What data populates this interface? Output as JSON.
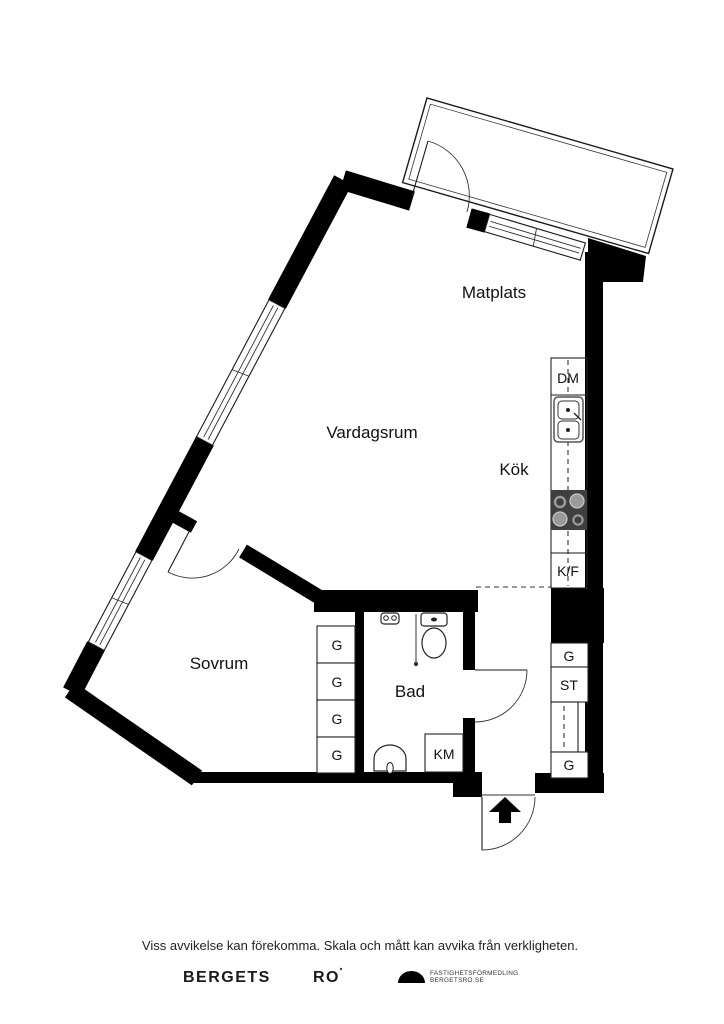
{
  "floorplan": {
    "labels": {
      "matplats": "Matplats",
      "vardagsrum": "Vardagsrum",
      "kok": "Kök",
      "sovrum": "Sovrum",
      "bad": "Bad",
      "dm": "DM",
      "kf": "K/F",
      "km": "KM"
    },
    "wardrobes": [
      "G",
      "G",
      "G",
      "G"
    ],
    "hall_cabinets": {
      "g_top": "G",
      "st": "ST",
      "g_bottom": "G"
    },
    "colors": {
      "wall": "#000000",
      "stove": "#3f3f3f",
      "burner_light": "#9a9a9a",
      "burner_ring": "#c8c8c8"
    }
  },
  "footer": {
    "disclaimer": "Viss avvikelse kan förekomma. Skala och mått kan avvika från verkligheten.",
    "brand_word1": "BERGETS",
    "brand_word2": "RO",
    "agency_line1": "FASTIGHETSFÖRMEDLING",
    "agency_line2": "BERGETSRO.SE"
  }
}
